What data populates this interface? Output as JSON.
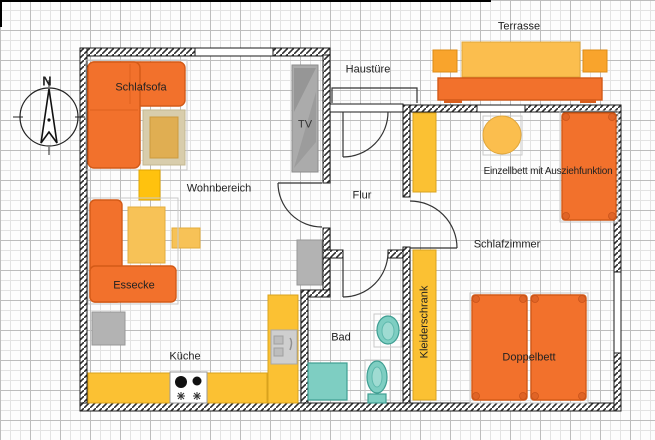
{
  "labels": {
    "terrasse": "Terrasse",
    "haustuere": "Haustüre",
    "schlafsofa": "Schlafsofa",
    "tv": "TV",
    "wohnbereich": "Wohnbereich",
    "flur": "Flur",
    "einzellbett": "Einzellbett mit Ausziehfunktion",
    "schlafzimmer": "Schlafzimmer",
    "essecke": "Essecke",
    "kleiderschrank": "Kleiderschrank",
    "bad": "Bad",
    "kueche": "Küche",
    "doppelbett": "Doppelbett",
    "compass_north": "N"
  },
  "palette": {
    "furniture_orange": "#F2712C",
    "furniture_orange_border": "#D35A17",
    "table_amber": "#FBBE4E",
    "cabinet_yellow": "#FBC133",
    "dining_yellow": "#F7C257",
    "chair_yellow": "#FFC20E",
    "terrace_chair_orange": "#F9A42C",
    "bath_teal": "#7ECEC2",
    "gray_item": "#B3B3B3",
    "rug_outer": "#D8CDAC",
    "rug_inner": "#E0AE52",
    "wall_line": "#1A1A1A",
    "grid_minor": "#E3E3E3",
    "grid_major": "#BDBDBD"
  }
}
